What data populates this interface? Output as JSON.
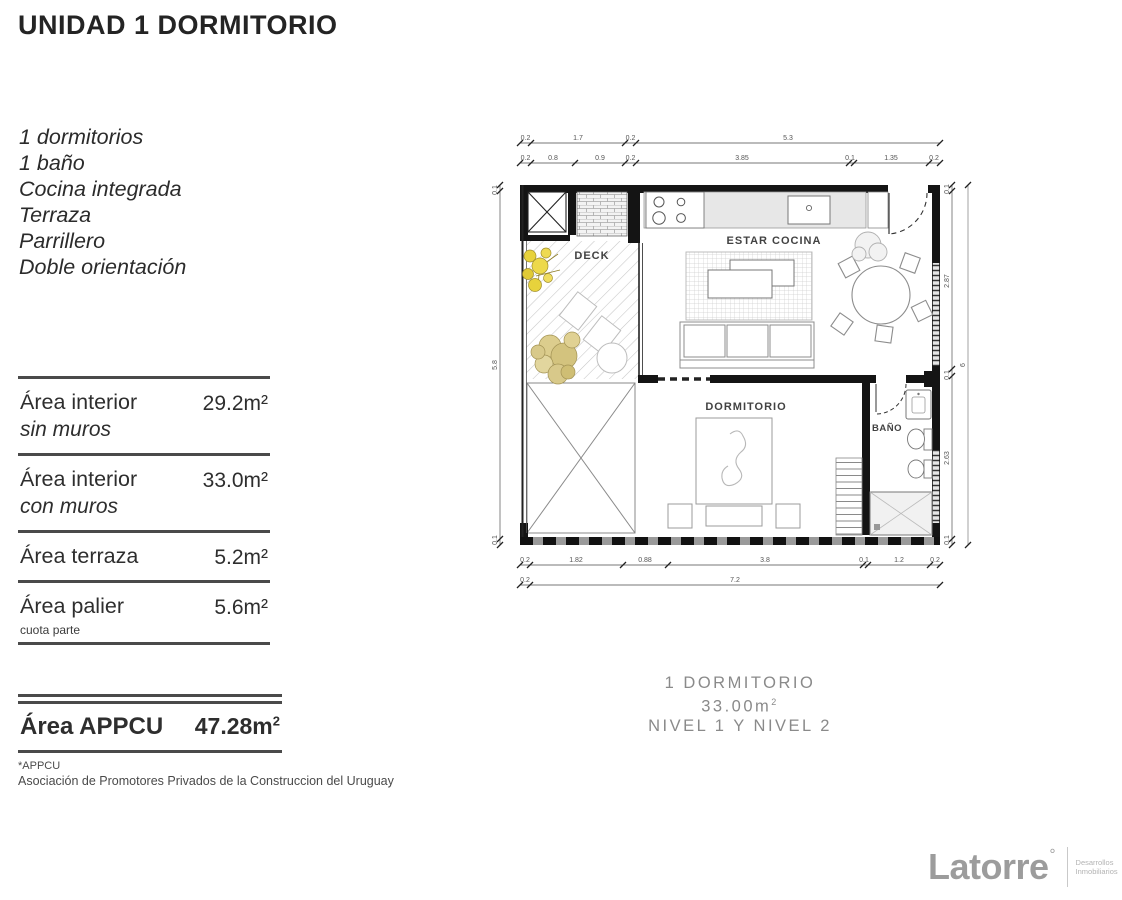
{
  "header": {
    "title": "UNIDAD 1 DORMITORIO"
  },
  "features": {
    "line1": "1 dormitorios",
    "line2": "1 baño",
    "line3": "Cocina integrada",
    "line4": "Terraza",
    "line5": "Parrillero",
    "line6": "Doble orientación"
  },
  "areas_table": {
    "rows": [
      {
        "label": "Área interior",
        "sublabel": "sin muros",
        "value": "29.2m²"
      },
      {
        "label": "Área interior",
        "sublabel": "con muros",
        "value": "33.0m²"
      },
      {
        "label": "Área terraza",
        "sublabel": "",
        "value": "5.2m²"
      },
      {
        "label": "Área palier",
        "sublabel": "cuota parte",
        "value": "5.6m²"
      }
    ]
  },
  "appcu": {
    "label": "Área APPCU",
    "value": "47.28m",
    "value_sup": "2",
    "footnote_mark": "*APPCU",
    "footnote": "Asociación de Promotores Privados de la Construccion del Uruguay"
  },
  "plan": {
    "rooms": {
      "deck": "DECK",
      "living": "ESTAR COCINA",
      "bedroom": "DORMITORIO",
      "bath": "BAÑO"
    },
    "dims": {
      "top_row1": [
        "0.2",
        "1.7",
        "0.2",
        "5.3"
      ],
      "top_row2": [
        "0.2",
        "0.8",
        "0.9",
        "0.2",
        "3.85",
        "0.1",
        "1.35",
        "0.2"
      ],
      "bottom_row1": [
        "0.2",
        "1.82",
        "0.88",
        "3.8",
        "0.1",
        "1.2",
        "0.2"
      ],
      "bottom_row2": [
        "0.2",
        "7.2"
      ],
      "left": [
        "0.1",
        "5.8",
        "0.1"
      ],
      "right_inner": [
        "0.1",
        "2.87",
        "0.1",
        "2.63",
        "0.1"
      ],
      "right_outer": "6"
    }
  },
  "caption": {
    "line1": "1 DORMITORIO",
    "area": "33.00m",
    "area_sup": "2",
    "line3": "NIVEL 1 Y NIVEL 2"
  },
  "logo": {
    "name": "Latorre",
    "mark": "°",
    "tagline_line1": "Desarrollos",
    "tagline_line2": "Inmobiliarios"
  },
  "colors": {
    "ink": "#242424",
    "wall_black": "#141414",
    "furniture_gray": "#8c8c8c",
    "counter_gray": "#e7e7e7",
    "flower_yellow": "#e7d23c",
    "tree_tan": "#d8c98a",
    "caption_gray": "#8a8a8a",
    "logo_gray": "#9c9c9c"
  }
}
